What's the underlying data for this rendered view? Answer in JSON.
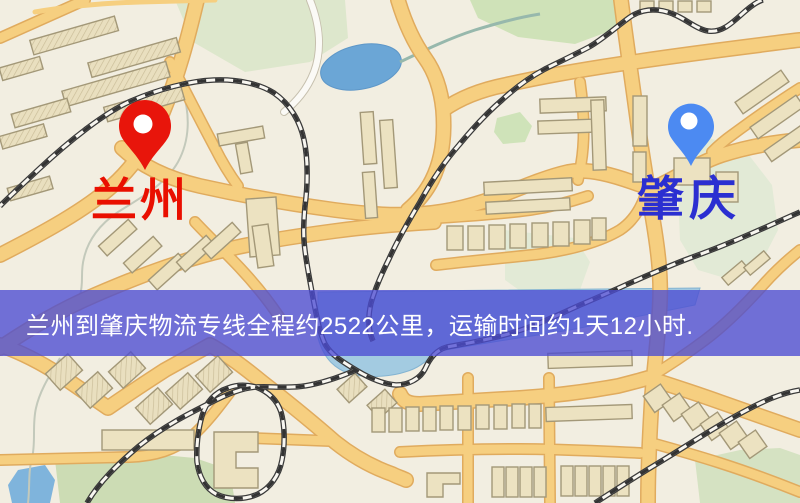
{
  "window": {
    "width": 800,
    "height": 503
  },
  "map": {
    "origin": {
      "name": "兰州",
      "pin_color": "#e8150b",
      "label_color": "#e90f00"
    },
    "destination": {
      "name": "肇庆",
      "pin_color": "#4c8af2",
      "label_color": "#2b2fd1"
    },
    "palette": {
      "background": "#f2eee1",
      "road_fill": "#f6cf80",
      "road_casing": "#e0ab5e",
      "building_fill": "#ece2c1",
      "building_outline": "#a39878",
      "park_green": "#cfe2b8",
      "park_pale": "#e2ead6",
      "water": "#6ba6d6",
      "water_light": "#a3cbe1",
      "railway": "#3a3a3a"
    }
  },
  "banner": {
    "text": "兰州到肇庆物流专线全程约2522公里，运输时间约1天12小时.",
    "background": "rgba(76,76,210,0.78)",
    "text_color": "#ffffff"
  }
}
